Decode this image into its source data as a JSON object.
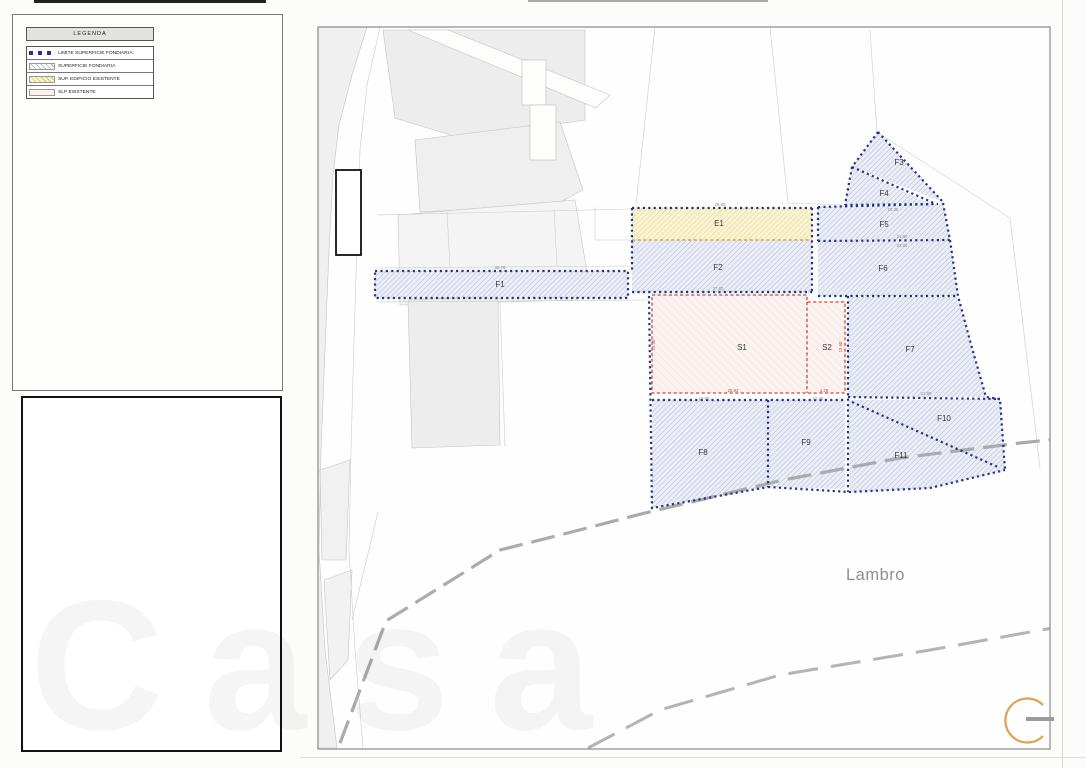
{
  "legend": {
    "title": "LEGENDA",
    "items": [
      {
        "label": "LIMITE SUPERFICIE FONDIARIA:",
        "swatch": "boundary-dots"
      },
      {
        "label": "SUPERFICIE FONDIARIA",
        "swatch": "blue-hatch"
      },
      {
        "label": "SUP. EDIFICIO ESISTENTE",
        "swatch": "yellow-hatch"
      },
      {
        "label": "SLP ESISTENTE",
        "swatch": "pink-fill"
      }
    ]
  },
  "map": {
    "river_label": "Lambro",
    "parcels": [
      {
        "label": "F1",
        "x": 500,
        "y": 287
      },
      {
        "label": "E1",
        "x": 719,
        "y": 226
      },
      {
        "label": "F2",
        "x": 718,
        "y": 270
      },
      {
        "label": "F3",
        "x": 899,
        "y": 165
      },
      {
        "label": "F4",
        "x": 884,
        "y": 196
      },
      {
        "label": "F5",
        "x": 884,
        "y": 227
      },
      {
        "label": "F6",
        "x": 883,
        "y": 271
      },
      {
        "label": "F7",
        "x": 910,
        "y": 352
      },
      {
        "label": "F8",
        "x": 703,
        "y": 455
      },
      {
        "label": "F9",
        "x": 806,
        "y": 445
      },
      {
        "label": "F10",
        "x": 944,
        "y": 421
      },
      {
        "label": "F11",
        "x": 901,
        "y": 458
      },
      {
        "label": "S1",
        "x": 742,
        "y": 350
      },
      {
        "label": "S2",
        "x": 827,
        "y": 350
      }
    ],
    "dimensions": [
      {
        "text": "29.30",
        "x": 720,
        "y": 206,
        "color": "gray"
      },
      {
        "text": "20.35",
        "x": 893,
        "y": 211,
        "color": "gray"
      },
      {
        "text": "21.90",
        "x": 902,
        "y": 238,
        "color": "gray"
      },
      {
        "text": "23.95",
        "x": 902,
        "y": 247,
        "color": "gray"
      },
      {
        "text": "27.80",
        "x": 718,
        "y": 290,
        "color": "gray"
      },
      {
        "text": "40.79",
        "x": 500,
        "y": 269,
        "color": "gray"
      },
      {
        "text": "25.92",
        "x": 733,
        "y": 392,
        "color": "red"
      },
      {
        "text": "4.29",
        "x": 824,
        "y": 392,
        "color": "red"
      },
      {
        "text": "19.60",
        "x": 704,
        "y": 400,
        "color": "gray"
      },
      {
        "text": "12.45",
        "x": 818,
        "y": 400,
        "color": "gray"
      },
      {
        "text": "21.80",
        "x": 926,
        "y": 395,
        "color": "gray"
      },
      {
        "text": "19.30",
        "x": 655,
        "y": 345,
        "color": "red",
        "rotate": true
      },
      {
        "text": "13.60",
        "x": 842,
        "y": 347,
        "color": "red",
        "rotate": true
      }
    ]
  },
  "watermark": {
    "text": "Casa"
  },
  "colors": {
    "gray": "#8a8a8a",
    "red": "#c25248",
    "navy": "#26357f",
    "orange": "#dfa243",
    "logo_arc": "#dba45c"
  }
}
